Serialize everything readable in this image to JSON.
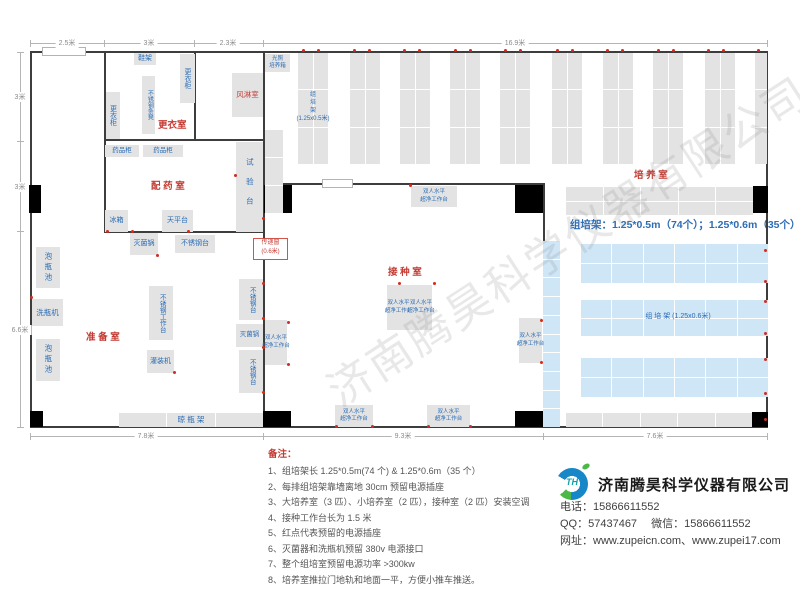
{
  "watermark": "济南腾昊科学仪器有限公司",
  "plan": {
    "walls": [
      {
        "x": 30,
        "y": 51,
        "w": 738,
        "h": 2
      },
      {
        "x": 30,
        "y": 426,
        "w": 738,
        "h": 2
      },
      {
        "x": 30,
        "y": 51,
        "w": 2,
        "h": 377
      },
      {
        "x": 766,
        "y": 51,
        "w": 2,
        "h": 377
      },
      {
        "x": 104,
        "y": 51,
        "w": 2,
        "h": 181
      },
      {
        "x": 194,
        "y": 51,
        "w": 2,
        "h": 89
      },
      {
        "x": 104,
        "y": 139,
        "w": 160,
        "h": 2
      },
      {
        "x": 104,
        "y": 231,
        "w": 160,
        "h": 2
      },
      {
        "x": 263,
        "y": 51,
        "w": 2,
        "h": 377
      },
      {
        "x": 263,
        "y": 183,
        "w": 281,
        "h": 2
      },
      {
        "x": 543,
        "y": 183,
        "w": 2,
        "h": 245
      }
    ],
    "openings": [
      {
        "x": 42,
        "y": 47,
        "w": 44,
        "h": 9
      },
      {
        "x": 322,
        "y": 179,
        "w": 31,
        "h": 9
      }
    ],
    "doors": [
      {
        "x": 29,
        "y": 185,
        "w": 12,
        "h": 28
      },
      {
        "x": 264,
        "y": 185,
        "w": 28,
        "h": 28
      },
      {
        "x": 515,
        "y": 185,
        "w": 28,
        "h": 28
      },
      {
        "x": 753,
        "y": 186,
        "w": 15,
        "h": 27
      },
      {
        "x": 30,
        "y": 411,
        "w": 13,
        "h": 16
      },
      {
        "x": 263,
        "y": 411,
        "w": 28,
        "h": 16
      },
      {
        "x": 515,
        "y": 411,
        "w": 28,
        "h": 16
      },
      {
        "x": 752,
        "y": 412,
        "w": 16,
        "h": 15
      }
    ],
    "racks": [
      {
        "x": 298,
        "y": 53,
        "w": 30,
        "h": 111,
        "rows": 3,
        "cols": 2,
        "color": "g"
      },
      {
        "x": 350,
        "y": 53,
        "w": 30,
        "h": 111,
        "rows": 3,
        "cols": 2,
        "color": "g"
      },
      {
        "x": 400,
        "y": 53,
        "w": 30,
        "h": 111,
        "rows": 3,
        "cols": 2,
        "color": "g"
      },
      {
        "x": 450,
        "y": 53,
        "w": 30,
        "h": 111,
        "rows": 3,
        "cols": 2,
        "color": "g"
      },
      {
        "x": 500,
        "y": 53,
        "w": 30,
        "h": 111,
        "rows": 3,
        "cols": 2,
        "color": "g"
      },
      {
        "x": 552,
        "y": 53,
        "w": 30,
        "h": 111,
        "rows": 3,
        "cols": 2,
        "color": "g"
      },
      {
        "x": 603,
        "y": 53,
        "w": 30,
        "h": 111,
        "rows": 3,
        "cols": 2,
        "color": "g"
      },
      {
        "x": 653,
        "y": 53,
        "w": 30,
        "h": 111,
        "rows": 3,
        "cols": 2,
        "color": "g"
      },
      {
        "x": 705,
        "y": 53,
        "w": 30,
        "h": 111,
        "rows": 3,
        "cols": 2,
        "color": "g"
      },
      {
        "x": 755,
        "y": 53,
        "w": 12,
        "h": 111,
        "rows": 3,
        "cols": 1,
        "color": "g"
      },
      {
        "x": 265,
        "y": 130,
        "w": 18,
        "h": 83,
        "rows": 3,
        "cols": 1,
        "color": "g"
      },
      {
        "x": 566,
        "y": 187,
        "w": 187,
        "h": 28,
        "rows": 2,
        "cols": 5,
        "color": "g"
      },
      {
        "x": 566,
        "y": 413,
        "w": 186,
        "h": 14,
        "rows": 1,
        "cols": 5,
        "color": "g"
      },
      {
        "x": 543,
        "y": 241,
        "w": 17,
        "h": 186,
        "rows": 10,
        "cols": 1,
        "color": "b"
      },
      {
        "x": 581,
        "y": 244,
        "w": 187,
        "h": 39,
        "rows": 2,
        "cols": 6,
        "color": "b"
      },
      {
        "x": 581,
        "y": 300,
        "w": 187,
        "h": 36,
        "rows": 2,
        "cols": 6,
        "color": "b"
      },
      {
        "x": 581,
        "y": 358,
        "w": 187,
        "h": 39,
        "rows": 2,
        "cols": 6,
        "color": "b"
      },
      {
        "x": 119,
        "y": 413,
        "w": 144,
        "h": 14,
        "rows": 1,
        "cols": 3,
        "color": "g"
      }
    ],
    "rooms": [
      {
        "label": "更衣室",
        "x": 158,
        "y": 117
      },
      {
        "label": "配 药 室",
        "x": 151,
        "y": 178
      },
      {
        "label": "准 备 室",
        "x": 86,
        "y": 329
      },
      {
        "label": "接 种 室",
        "x": 388,
        "y": 264
      },
      {
        "label": "培 养 室",
        "x": 634,
        "y": 167
      }
    ],
    "equipment": [
      {
        "label": "鞋架",
        "x": 134,
        "y": 53,
        "w": 22,
        "h": 12
      },
      {
        "label": "更衣柜",
        "x": 180,
        "y": 54,
        "w": 15,
        "h": 49,
        "dir": "v"
      },
      {
        "label": "不锈钢条凳",
        "x": 142,
        "y": 76,
        "w": 13,
        "h": 58,
        "dir": "v",
        "fs": 6
      },
      {
        "label": "更衣柜",
        "x": 106,
        "y": 92,
        "w": 14,
        "h": 47,
        "dir": "v"
      },
      {
        "label": "风淋室",
        "x": 232,
        "y": 73,
        "w": 31,
        "h": 44,
        "red": true,
        "fs": 7.5
      },
      {
        "lines": [
          "光照",
          "培养箱"
        ],
        "x": 265,
        "y": 54,
        "w": 25,
        "h": 18,
        "fs": 5.5
      },
      {
        "label": "药品柜",
        "x": 105,
        "y": 145,
        "w": 34,
        "h": 12,
        "fs": 6.5
      },
      {
        "label": "药品柜",
        "x": 143,
        "y": 145,
        "w": 40,
        "h": 12,
        "fs": 6.5
      },
      {
        "label": "试验台",
        "x": 236,
        "y": 142,
        "w": 27,
        "h": 90,
        "dir": "v",
        "fs": 7.5,
        "ls": 12
      },
      {
        "label": "冰箱",
        "x": 105,
        "y": 210,
        "w": 23,
        "h": 22
      },
      {
        "label": "天平台",
        "x": 162,
        "y": 210,
        "w": 31,
        "h": 22
      },
      {
        "label": "灭菌锅",
        "x": 130,
        "y": 233,
        "w": 28,
        "h": 22
      },
      {
        "label": "不锈钢台",
        "x": 175,
        "y": 235,
        "w": 40,
        "h": 18
      },
      {
        "label": "泡瓶池",
        "x": 36,
        "y": 247,
        "w": 24,
        "h": 41,
        "dir": "v",
        "fs": 7.5,
        "ls": 3
      },
      {
        "label": "洗瓶机",
        "x": 32,
        "y": 299,
        "w": 31,
        "h": 27,
        "fs": 7.5
      },
      {
        "label": "泡瓶池",
        "x": 36,
        "y": 339,
        "w": 24,
        "h": 42,
        "dir": "v",
        "fs": 7.5,
        "ls": 3
      },
      {
        "label": "不锈钢工作台",
        "x": 149,
        "y": 286,
        "w": 24,
        "h": 54,
        "dir": "v",
        "fs": 6.5
      },
      {
        "label": "灌装机",
        "x": 147,
        "y": 350,
        "w": 27,
        "h": 23
      },
      {
        "label": "不锈钢台",
        "x": 239,
        "y": 279,
        "w": 24,
        "h": 41,
        "dir": "v",
        "fs": 6.5
      },
      {
        "label": "灭菌锅",
        "x": 236,
        "y": 324,
        "w": 27,
        "h": 23,
        "fs": 6.5
      },
      {
        "label": "不锈钢台",
        "x": 239,
        "y": 350,
        "w": 24,
        "h": 43,
        "dir": "v",
        "fs": 6.5
      },
      {
        "lines": [
          "双人水平",
          "超净工作台"
        ],
        "x": 411,
        "y": 186,
        "w": 46,
        "h": 21,
        "fs": 5.5
      },
      {
        "lines": [
          "双人水平",
          "超净工作台"
        ],
        "x": 265,
        "y": 320,
        "w": 22,
        "h": 45,
        "fs": 5.5
      },
      {
        "lines": [
          "双人水平",
          "超净工作台"
        ],
        "x": 387,
        "y": 285,
        "w": 23,
        "h": 45,
        "fs": 5.5
      },
      {
        "lines": [
          "双人水平",
          "超净工作台"
        ],
        "x": 410,
        "y": 285,
        "w": 22,
        "h": 45,
        "fs": 5.5
      },
      {
        "lines": [
          "双人水平",
          "超净工作台"
        ],
        "x": 519,
        "y": 318,
        "w": 23,
        "h": 45,
        "fs": 5.5
      },
      {
        "lines": [
          "双人水平",
          "超净工作台"
        ],
        "x": 335,
        "y": 405,
        "w": 38,
        "h": 22,
        "fs": 5.5
      },
      {
        "lines": [
          "双人水平",
          "超净工作台"
        ],
        "x": 427,
        "y": 405,
        "w": 43,
        "h": 22,
        "fs": 5.5
      },
      {
        "lines": [
          "组",
          "培",
          "架",
          "(1.25x0.5米)"
        ],
        "x": 291,
        "y": 85,
        "w": 44,
        "h": 46,
        "box": false,
        "fs": 6
      },
      {
        "label": "组  培  架 (1.25x0.6米)",
        "x": 598,
        "y": 310,
        "w": 160,
        "h": 13,
        "box": false,
        "fs": 7
      },
      {
        "label": "晾  瓶  架",
        "x": 119,
        "y": 413,
        "w": 144,
        "h": 14,
        "box": false,
        "fs": 7.5
      }
    ],
    "pass_window": {
      "line1": "传递窗",
      "line2": "(0.6米)",
      "x": 253,
      "y": 238,
      "w": 35,
      "h": 22
    },
    "spec": {
      "text": "组培架：1.25*0.5m（74个）；1.25*0.6m（35个）",
      "x": 570,
      "y": 217
    },
    "red_dots": [
      [
        303,
        50
      ],
      [
        318,
        50
      ],
      [
        354,
        50
      ],
      [
        369,
        50
      ],
      [
        404,
        50
      ],
      [
        419,
        50
      ],
      [
        455,
        50
      ],
      [
        470,
        50
      ],
      [
        505,
        50
      ],
      [
        520,
        50
      ],
      [
        557,
        50
      ],
      [
        572,
        50
      ],
      [
        607,
        50
      ],
      [
        622,
        50
      ],
      [
        658,
        50
      ],
      [
        673,
        50
      ],
      [
        708,
        50
      ],
      [
        723,
        50
      ],
      [
        758,
        50
      ],
      [
        765,
        250
      ],
      [
        765,
        281
      ],
      [
        765,
        301
      ],
      [
        765,
        333
      ],
      [
        765,
        359
      ],
      [
        765,
        393
      ],
      [
        765,
        419
      ],
      [
        263,
        218
      ],
      [
        263,
        240
      ],
      [
        263,
        283
      ],
      [
        263,
        318
      ],
      [
        263,
        347
      ],
      [
        263,
        392
      ],
      [
        410,
        185
      ],
      [
        399,
        283
      ],
      [
        434,
        283
      ],
      [
        288,
        322
      ],
      [
        288,
        364
      ],
      [
        541,
        320
      ],
      [
        541,
        362
      ],
      [
        336,
        426
      ],
      [
        372,
        426
      ],
      [
        428,
        426
      ],
      [
        470,
        426
      ],
      [
        107,
        231
      ],
      [
        132,
        231
      ],
      [
        188,
        231
      ],
      [
        235,
        175
      ],
      [
        31,
        297
      ],
      [
        157,
        255
      ],
      [
        174,
        372
      ]
    ],
    "dim_lines": [
      {
        "x": 30,
        "y": 43,
        "w": 738,
        "h": 1
      },
      {
        "x": 20,
        "y": 52,
        "w": 1,
        "h": 376
      },
      {
        "x": 30,
        "y": 436,
        "w": 738,
        "h": 1
      }
    ],
    "dim_ticks": [
      {
        "x": 30,
        "y": 40,
        "w": 1,
        "h": 7
      },
      {
        "x": 104,
        "y": 40,
        "w": 1,
        "h": 7
      },
      {
        "x": 194,
        "y": 40,
        "w": 1,
        "h": 7
      },
      {
        "x": 263,
        "y": 40,
        "w": 1,
        "h": 7
      },
      {
        "x": 767,
        "y": 40,
        "w": 1,
        "h": 7
      },
      {
        "x": 17,
        "y": 52,
        "w": 7,
        "h": 1
      },
      {
        "x": 17,
        "y": 141,
        "w": 7,
        "h": 1
      },
      {
        "x": 17,
        "y": 231,
        "w": 7,
        "h": 1
      },
      {
        "x": 17,
        "y": 427,
        "w": 7,
        "h": 1
      },
      {
        "x": 30,
        "y": 433,
        "w": 1,
        "h": 7
      },
      {
        "x": 263,
        "y": 433,
        "w": 1,
        "h": 7
      },
      {
        "x": 543,
        "y": 433,
        "w": 1,
        "h": 7
      },
      {
        "x": 767,
        "y": 433,
        "w": 1,
        "h": 7
      }
    ],
    "dim_labels": [
      {
        "t": "2.5米",
        "x": 67,
        "y": 43
      },
      {
        "t": "3米",
        "x": 149,
        "y": 43
      },
      {
        "t": "2.3米",
        "x": 228,
        "y": 43
      },
      {
        "t": "16.9米",
        "x": 515,
        "y": 43
      },
      {
        "t": "3米",
        "x": 20,
        "y": 97
      },
      {
        "t": "3米",
        "x": 20,
        "y": 187
      },
      {
        "t": "6.6米",
        "x": 20,
        "y": 330
      },
      {
        "t": "7.8米",
        "x": 146,
        "y": 436
      },
      {
        "t": "9.3米",
        "x": 403,
        "y": 436
      },
      {
        "t": "7.6米",
        "x": 655,
        "y": 436
      }
    ]
  },
  "notes": {
    "title": "备注：",
    "items": [
      "1、组培架长 1.25*0.5m(74 个) & 1.25*0.6m（35 个）",
      "2、每排组培架靠墙离地 30cm 预留电源插座",
      "3、大培养室（3 匹）、小培养室（2 匹），接种室（2 匹）安装空调",
      "4、接种工作台长为 1.5 米",
      "5、红点代表预留的电源插座",
      "6、灭菌器和洗瓶机预留 380v 电源接口",
      "7、整个组培室预留电源功率 >300kw",
      "8、培养室推拉门地轨和地面一平，方便小推车推送。"
    ]
  },
  "company": {
    "name": "济南腾昊科学仪器有限公司",
    "logo_text": "TH",
    "phone_line": "电话：15866611552",
    "qq_line": "QQ：57437467　 微信：15866611552",
    "web_line": "网址：www.zupeicn.com、www.zupei17.com"
  }
}
